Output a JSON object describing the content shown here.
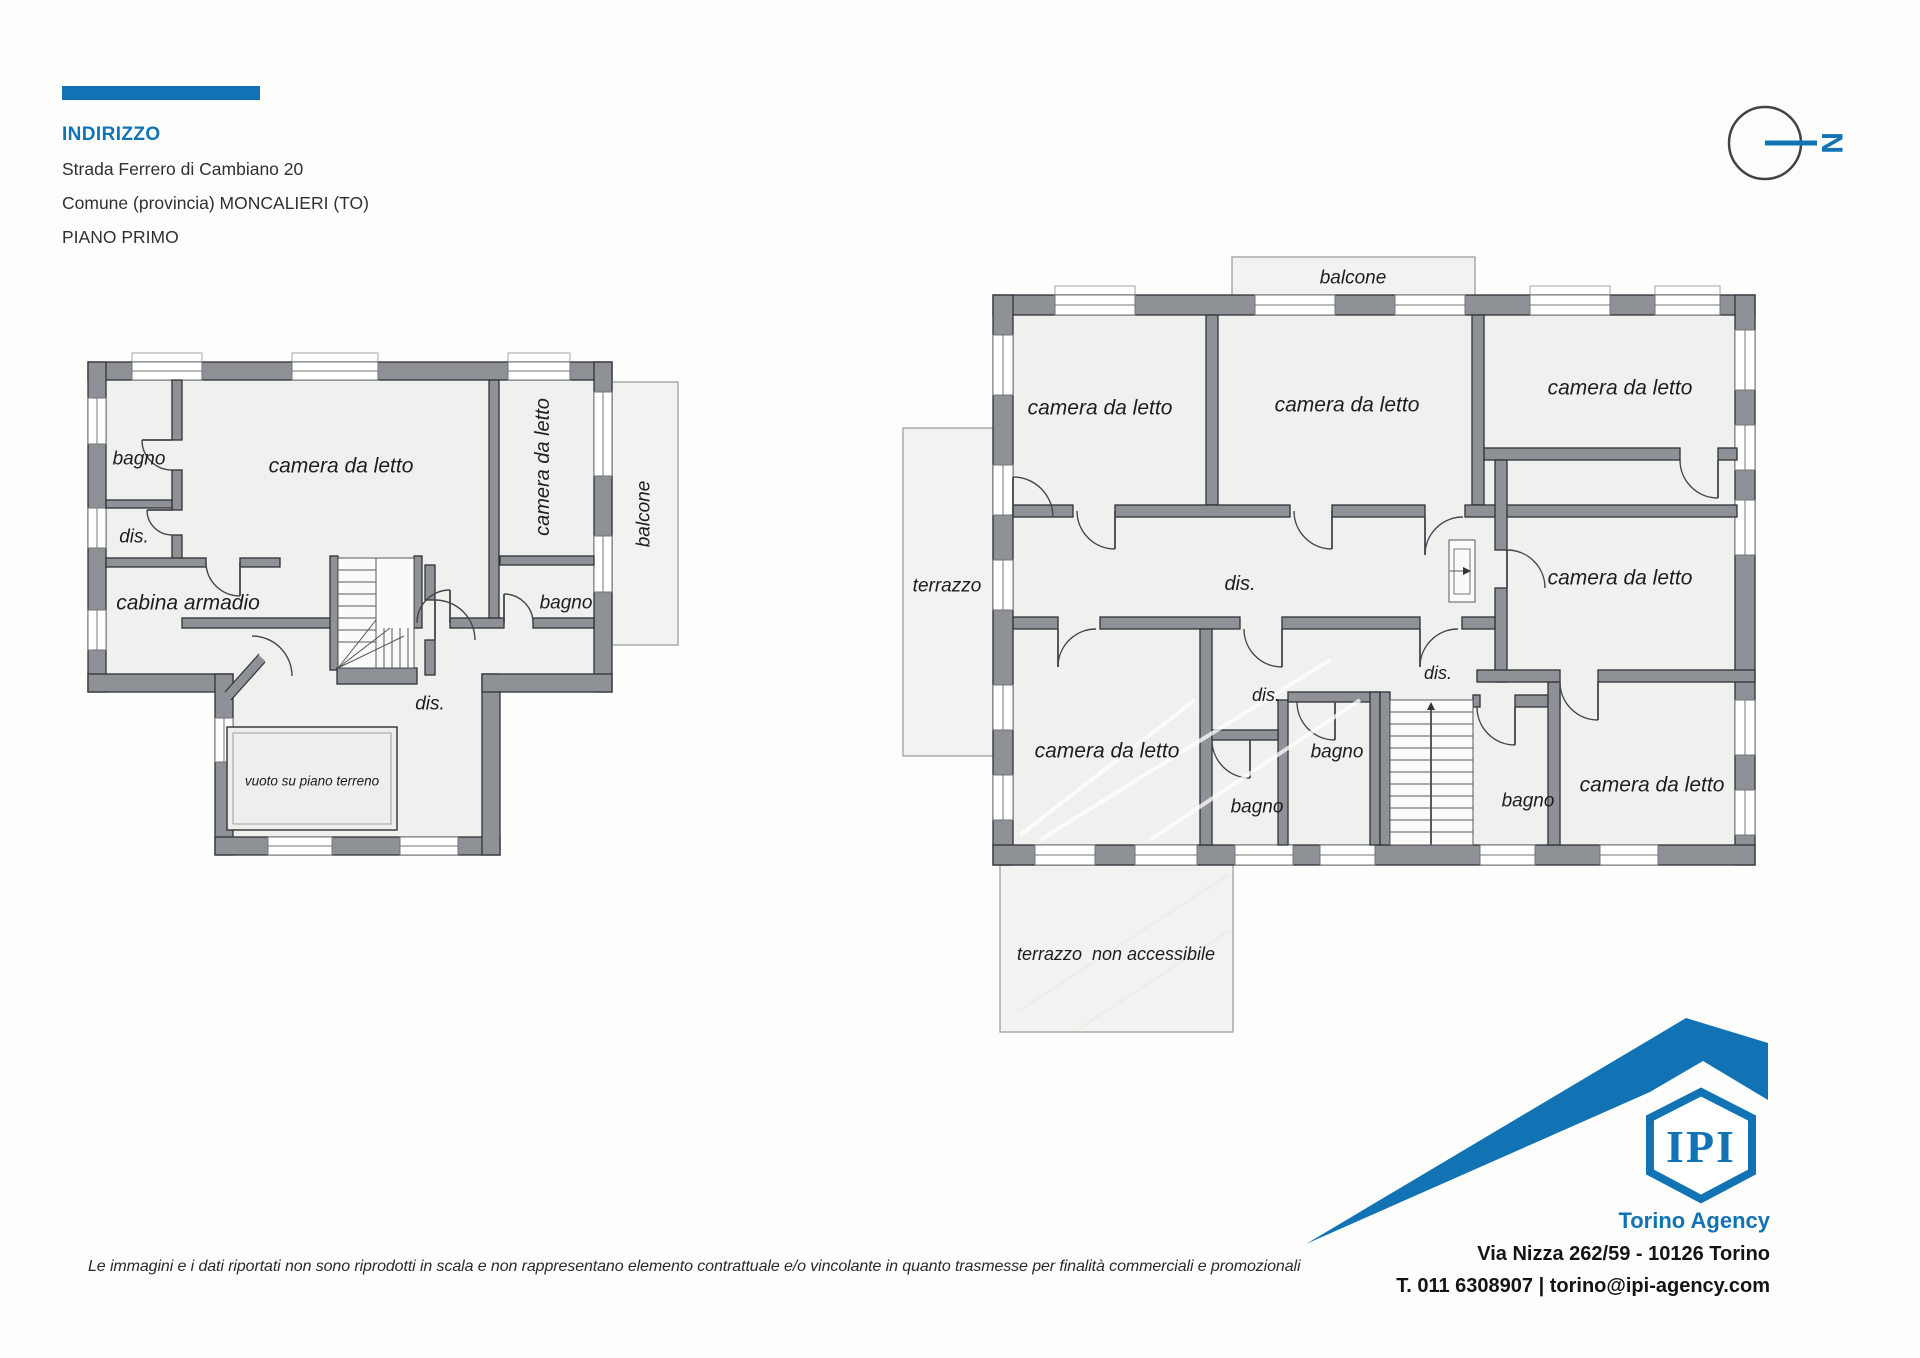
{
  "header": {
    "title": "INDIRIZZO",
    "address_line1": "Strada Ferrero di Cambiano 20",
    "address_line2": "Comune (provincia) MONCALIERI (TO)",
    "floor": "PIANO PRIMO"
  },
  "compass": {
    "label": "N"
  },
  "colors": {
    "accent_blue": "#1173b4",
    "wall_gray": "#8e9297",
    "room_fill": "#f0f0ee",
    "text_dark": "#1d1d1b"
  },
  "plan_left": {
    "labels": {
      "bagno_top": "bagno",
      "camera_main": "camera da letto",
      "dis_upper": "dis.",
      "cabina": "cabina armadio",
      "camera_vert": "camera da letto",
      "balcone": "balcone",
      "bagno_right": "bagno",
      "dis_lower": "dis.",
      "vuoto": "vuoto su piano terreno"
    }
  },
  "plan_right": {
    "labels": {
      "balcone": "balcone",
      "camera_1": "camera da letto",
      "camera_2": "camera da letto",
      "camera_3": "camera da letto",
      "terrazzo": "terrazzo",
      "dis_main": "dis.",
      "camera_4": "camera da letto",
      "camera_5": "camera da letto",
      "dis_small_left": "dis.",
      "dis_small_right": "dis.",
      "bagno_left": "bagno",
      "bagno_mid": "bagno",
      "bagno_right": "bagno",
      "camera_6": "camera da letto",
      "terrazzo_na": "terrazzo  non accessibile"
    }
  },
  "footer": {
    "disclaimer": "Le immagini e i dati riportati non sono riprodotti in scala e non rappresentano elemento contrattuale e/o vincolante in quanto trasmesse per finalità commerciali e promozionali",
    "logo_text": "IPI",
    "agency_name": "Torino Agency",
    "agency_address": "Via Nizza 262/59 - 10126 Torino",
    "agency_contacts": "T. 011 6308907 | torino@ipi-agency.com"
  }
}
